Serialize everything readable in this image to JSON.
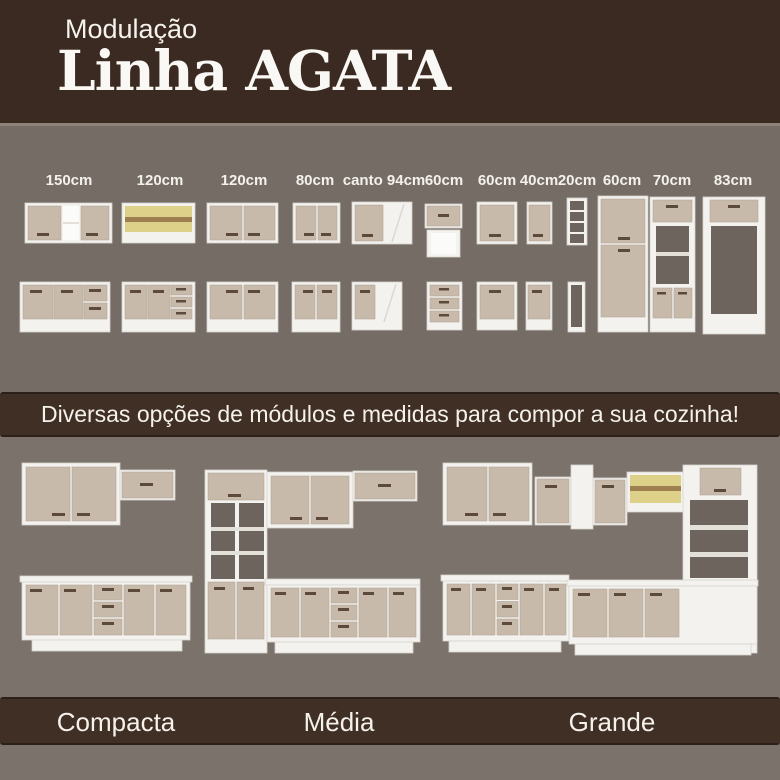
{
  "header": {
    "kicker": "Modulação",
    "title": "Linha AGATA"
  },
  "modules": {
    "labels": [
      "150cm",
      "120cm",
      "120cm",
      "80cm",
      "canto 94cm",
      "60cm",
      "60cm",
      "40cm",
      "20cm",
      "60cm",
      "70cm",
      "83cm"
    ]
  },
  "middle_band": {
    "text": "Diversas opções de módulos e medidas para compor a sua cozinha!"
  },
  "kitchens": {
    "labels": [
      "Compacta",
      "Média",
      "Grande"
    ]
  },
  "colors": {
    "dark_brown": "#3a2a21",
    "band_brown": "#402f25",
    "taupe_background": "#756c65",
    "taupe_light": "#7b726b",
    "cabinet_white": "#f3f2ef",
    "door_beige": "#c8baab",
    "handle_brown": "#5e4a3a",
    "glass_yellow": "#ddd189",
    "text_white": "#f5f1eb"
  }
}
